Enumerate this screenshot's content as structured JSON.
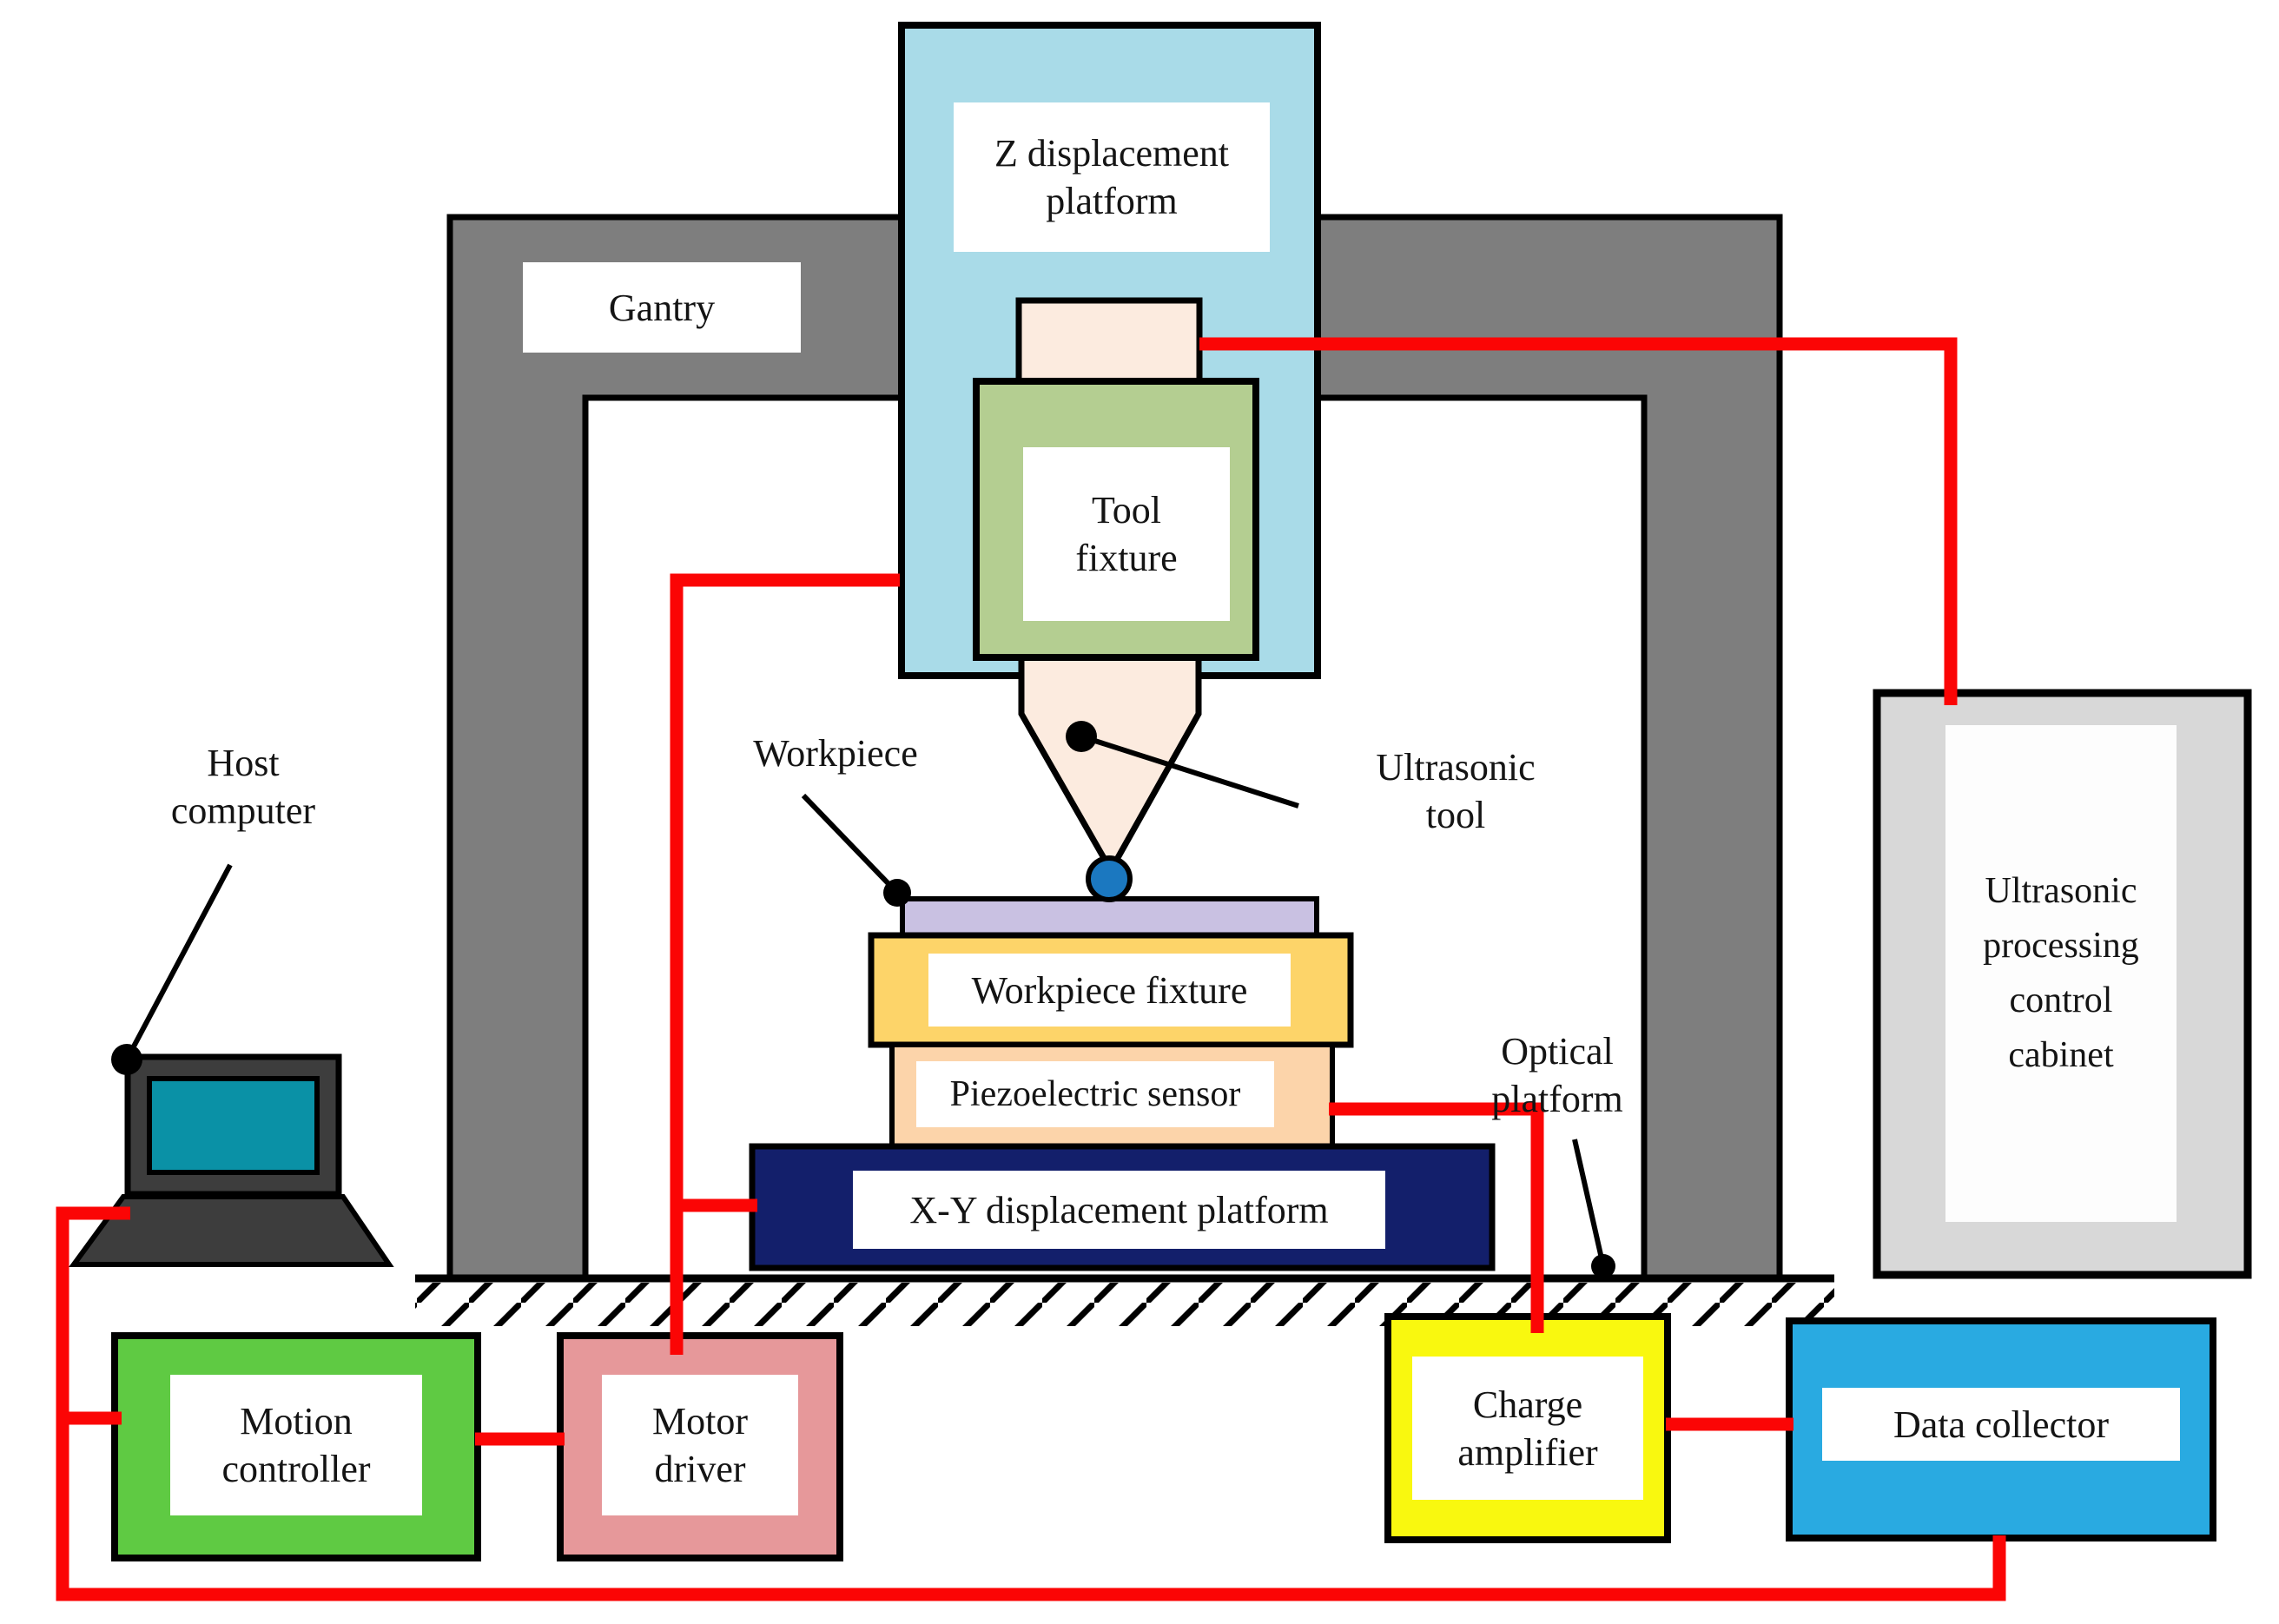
{
  "diagram": {
    "type": "schematic",
    "components": {
      "gantry": {
        "label": "Gantry",
        "color": "#7e7e7e"
      },
      "z_displacement_platform": {
        "label": "Z displacement\nplatform",
        "color": "#a9dbe8"
      },
      "tool_fixture": {
        "label": "Tool\nfixture",
        "color": "#b4ce91"
      },
      "ultrasonic_tool": {
        "label": "Ultrasonic\ntool",
        "color": "#fcebdf",
        "tip_ball_color": "#1b78c0"
      },
      "workpiece": {
        "label": "Workpiece",
        "color": "#c9c1e2"
      },
      "workpiece_fixture": {
        "label": "Workpiece fixture",
        "color": "#fdd469"
      },
      "piezoelectric_sensor": {
        "label": "Piezoelectric sensor",
        "color": "#fcd4aa"
      },
      "xy_displacement_platform": {
        "label": "X-Y displacement platform",
        "color": "#131f6b"
      },
      "optical_platform": {
        "label": "Optical\nplatform"
      },
      "host_computer": {
        "label": "Host\ncomputer",
        "color": "#3d3d3d",
        "screen_color": "#0a91a6"
      },
      "motion_controller": {
        "label": "Motion\ncontroller",
        "color": "#5fca43"
      },
      "motor_driver": {
        "label": "Motor\ndriver",
        "color": "#e6989a"
      },
      "charge_amplifier": {
        "label": "Charge\namplifier",
        "color": "#f9f80f"
      },
      "data_collector": {
        "label": "Data collector",
        "color": "#29aae1"
      },
      "control_cabinet": {
        "label": "Ultrasonic\nprocessing\ncontrol\ncabinet",
        "color": "#d8d8d8"
      }
    },
    "wires": {
      "color": "#fb0505",
      "connections": [
        "Ultrasonic tool → Ultrasonic processing control cabinet",
        "Z displacement platform → Motor driver",
        "Motor driver riser → X-Y displacement platform (branch)",
        "Piezoelectric sensor → Charge amplifier",
        "Charge amplifier → Data collector",
        "Motion controller → Motor driver",
        "Host computer → Motion controller",
        "Host computer → Data collector (bottom bus)"
      ]
    }
  }
}
